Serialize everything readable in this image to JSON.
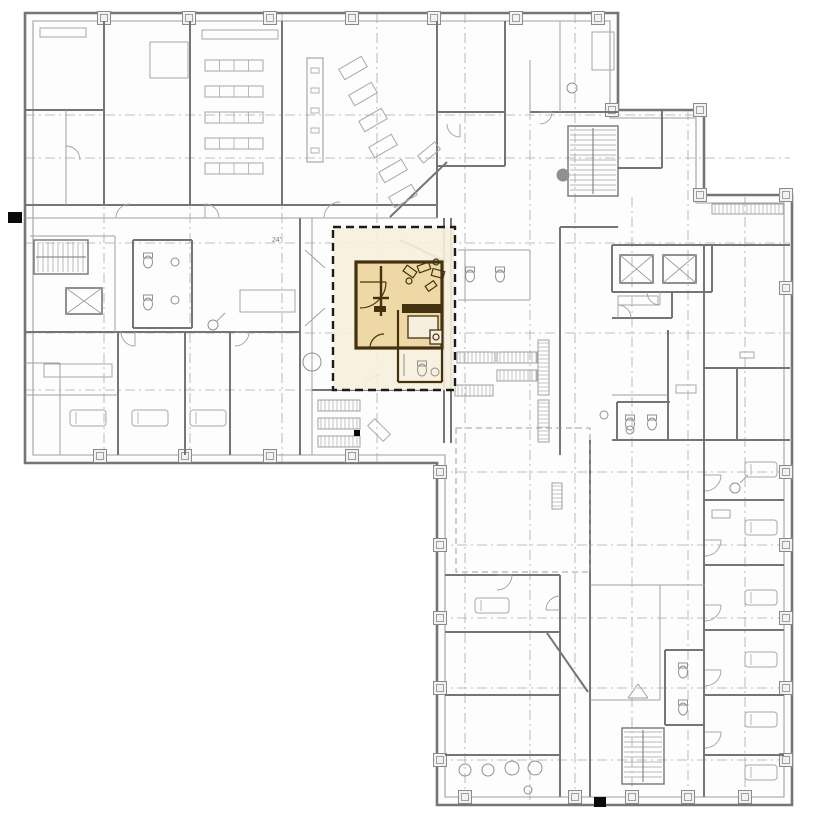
{
  "meta": {
    "title": "Hospital floor plan with highlighted patient-room unit",
    "dim_note": "24'"
  },
  "canvas": {
    "w": 826,
    "h": 826,
    "bg": "#ffffff"
  },
  "palette": {
    "wall": "#757575",
    "thin": "#a0a0a0",
    "furniture": "#a8a8a8",
    "grid": "#aaaaaa",
    "paper": "#fdfdfd",
    "marker_stroke": "#8a8a8a",
    "marker_fill": "#f2f2f2",
    "fixture": "#909090",
    "black": "#0a0a0a",
    "highlight_fill": "#f7efdd",
    "highlight_room_fill": "#eed9a6",
    "highlight_wall": "#43310f",
    "highlight_border": "#1c1c1c",
    "text": "#7a7a7a"
  },
  "outline": {
    "outer": "25,13 618,13 618,110 704,110 704,195 792,195 792,805 437,805 437,463 25,463",
    "inner": "33,21 610,21 610,118 696,118 696,203 784,203 784,797 445,797 445,455 33,455"
  },
  "grid": {
    "vertical": [
      [
        104,
        13,
        463
      ],
      [
        190,
        13,
        463
      ],
      [
        282,
        13,
        463
      ],
      [
        377,
        13,
        463
      ],
      [
        465,
        13,
        805
      ],
      [
        530,
        110,
        805
      ],
      [
        575,
        13,
        805
      ],
      [
        632,
        197,
        805
      ],
      [
        688,
        110,
        805
      ],
      [
        745,
        197,
        805
      ]
    ],
    "horizontal": [
      [
        115,
        25,
        700
      ],
      [
        158,
        25,
        790
      ],
      [
        243,
        25,
        790
      ],
      [
        333,
        25,
        790
      ],
      [
        390,
        25,
        437
      ],
      [
        472,
        437,
        790
      ],
      [
        545,
        437,
        790
      ],
      [
        618,
        437,
        790
      ],
      [
        688,
        437,
        790
      ],
      [
        760,
        437,
        790
      ]
    ]
  },
  "column_markers": [
    [
      104,
      18
    ],
    [
      189,
      18
    ],
    [
      270,
      18
    ],
    [
      352,
      18
    ],
    [
      434,
      18
    ],
    [
      516,
      18
    ],
    [
      598,
      18
    ],
    [
      612,
      110
    ],
    [
      700,
      110
    ],
    [
      700,
      195
    ],
    [
      786,
      195
    ],
    [
      100,
      456
    ],
    [
      185,
      456
    ],
    [
      270,
      456
    ],
    [
      352,
      456
    ],
    [
      440,
      472
    ],
    [
      440,
      545
    ],
    [
      440,
      618
    ],
    [
      440,
      688
    ],
    [
      440,
      760
    ],
    [
      786,
      288
    ],
    [
      786,
      472
    ],
    [
      786,
      545
    ],
    [
      786,
      618
    ],
    [
      786,
      688
    ],
    [
      786,
      760
    ],
    [
      465,
      797
    ],
    [
      575,
      797
    ],
    [
      632,
      797
    ],
    [
      688,
      797
    ],
    [
      745,
      797
    ]
  ],
  "walls": [
    [
      104,
      21,
      104,
      205
    ],
    [
      190,
      21,
      190,
      205
    ],
    [
      282,
      21,
      282,
      205
    ],
    [
      437,
      21,
      437,
      218
    ],
    [
      25,
      110,
      104,
      110
    ],
    [
      25,
      205,
      437,
      205
    ],
    [
      437,
      112,
      505,
      112
    ],
    [
      530,
      112,
      618,
      112
    ],
    [
      505,
      21,
      505,
      112
    ],
    [
      437,
      166,
      505,
      166
    ],
    [
      505,
      112,
      505,
      166
    ],
    [
      390,
      217,
      447,
      162
    ],
    [
      25,
      332,
      300,
      332
    ],
    [
      300,
      218,
      300,
      455
    ],
    [
      133,
      240,
      192,
      240
    ],
    [
      133,
      240,
      133,
      328
    ],
    [
      192,
      240,
      192,
      328
    ],
    [
      133,
      328,
      192,
      328
    ],
    [
      118,
      332,
      118,
      455
    ],
    [
      185,
      332,
      185,
      455
    ],
    [
      230,
      332,
      230,
      455
    ],
    [
      312,
      390,
      437,
      390
    ],
    [
      444,
      218,
      444,
      443
    ],
    [
      451,
      218,
      451,
      443
    ],
    [
      400,
      240,
      447,
      262
    ],
    [
      618,
      168,
      662,
      168
    ],
    [
      662,
      110,
      662,
      168
    ],
    [
      704,
      245,
      790,
      245
    ],
    [
      704,
      245,
      704,
      797
    ],
    [
      612,
      245,
      712,
      245
    ],
    [
      612,
      292,
      712,
      292
    ],
    [
      612,
      245,
      612,
      292
    ],
    [
      712,
      245,
      712,
      292
    ],
    [
      672,
      292,
      672,
      318
    ],
    [
      612,
      318,
      672,
      318
    ],
    [
      560,
      227,
      618,
      227
    ],
    [
      560,
      227,
      560,
      455
    ],
    [
      612,
      440,
      790,
      440
    ],
    [
      668,
      330,
      668,
      440
    ],
    [
      737,
      368,
      737,
      440
    ],
    [
      704,
      368,
      790,
      368
    ],
    [
      590,
      440,
      590,
      797
    ],
    [
      560,
      575,
      560,
      797
    ],
    [
      445,
      575,
      560,
      575
    ],
    [
      445,
      632,
      560,
      632
    ],
    [
      445,
      695,
      560,
      695
    ],
    [
      445,
      755,
      560,
      755
    ],
    [
      547,
      633,
      588,
      692
    ],
    [
      705,
      500,
      784,
      500
    ],
    [
      705,
      565,
      784,
      565
    ],
    [
      705,
      630,
      784,
      630
    ],
    [
      705,
      695,
      784,
      695
    ],
    [
      705,
      755,
      784,
      755
    ],
    [
      617,
      402,
      617,
      440
    ],
    [
      617,
      402,
      670,
      402
    ],
    [
      665,
      650,
      665,
      725
    ],
    [
      665,
      650,
      705,
      650
    ],
    [
      665,
      725,
      705,
      725
    ]
  ],
  "thin_walls": [
    [
      66,
      110,
      66,
      205
    ],
    [
      25,
      218,
      437,
      218
    ],
    [
      312,
      218,
      312,
      455
    ],
    [
      115,
      236,
      115,
      332
    ],
    [
      30,
      236,
      115,
      236
    ],
    [
      60,
      363,
      60,
      455
    ],
    [
      25,
      363,
      60,
      363
    ],
    [
      25,
      395,
      118,
      395
    ],
    [
      530,
      60,
      530,
      112
    ],
    [
      560,
      21,
      560,
      112
    ],
    [
      590,
      585,
      705,
      585
    ],
    [
      660,
      585,
      660,
      700
    ],
    [
      590,
      700,
      660,
      700
    ],
    [
      612,
      395,
      668,
      395
    ],
    [
      465,
      250,
      465,
      300
    ],
    [
      530,
      250,
      530,
      300
    ],
    [
      458,
      250,
      530,
      250
    ],
    [
      458,
      300,
      530,
      300
    ],
    [
      305,
      250,
      325,
      268
    ],
    [
      305,
      326,
      325,
      308
    ],
    [
      628,
      698,
      648,
      698
    ],
    [
      628,
      698,
      638,
      684
    ],
    [
      648,
      698,
      638,
      684
    ],
    [
      217,
      321,
      225,
      313
    ],
    [
      740,
      483,
      748,
      475
    ]
  ],
  "furniture_rects": [
    [
      40,
      28,
      46,
      9
    ],
    [
      202,
      30,
      76,
      9
    ],
    [
      592,
      32,
      22,
      38
    ],
    [
      150,
      42,
      38,
      36
    ],
    [
      240,
      290,
      55,
      22
    ],
    [
      44,
      364,
      68,
      13
    ],
    [
      618,
      296,
      40,
      9
    ],
    [
      676,
      385,
      20,
      8
    ],
    [
      712,
      510,
      18,
      8
    ],
    [
      740,
      352,
      14,
      6
    ]
  ],
  "tables": [
    [
      205,
      60,
      58,
      11,
      4
    ],
    [
      205,
      86,
      58,
      11,
      4
    ],
    [
      205,
      112,
      58,
      11,
      4
    ],
    [
      205,
      138,
      58,
      11,
      4
    ],
    [
      205,
      163,
      58,
      11,
      4
    ]
  ],
  "beds": [
    [
      70,
      410,
      36,
      16
    ],
    [
      132,
      410,
      36,
      16
    ],
    [
      190,
      410,
      36,
      16
    ],
    [
      745,
      462,
      32,
      15
    ],
    [
      745,
      520,
      32,
      15
    ],
    [
      745,
      590,
      32,
      15
    ],
    [
      745,
      652,
      32,
      15
    ],
    [
      745,
      712,
      32,
      15
    ],
    [
      745,
      765,
      32,
      15
    ],
    [
      475,
      598,
      34,
      15
    ]
  ],
  "rotated_rects": [
    [
      340,
      62,
      26,
      12,
      -30
    ],
    [
      350,
      88,
      26,
      12,
      -30
    ],
    [
      360,
      114,
      26,
      12,
      -30
    ],
    [
      370,
      140,
      26,
      12,
      -30
    ],
    [
      380,
      165,
      26,
      12,
      -30
    ],
    [
      390,
      190,
      26,
      12,
      -30
    ],
    [
      418,
      148,
      22,
      9,
      -40
    ],
    [
      368,
      425,
      22,
      10,
      45
    ]
  ],
  "circles": [
    [
      175,
      262,
      4,
      0
    ],
    [
      175,
      300,
      4,
      0
    ],
    [
      572,
      88,
      5,
      0
    ],
    [
      563,
      175,
      6,
      1
    ],
    [
      213,
      325,
      5,
      0
    ],
    [
      735,
      488,
      5,
      0
    ],
    [
      604,
      415,
      4,
      0
    ],
    [
      312,
      362,
      9,
      0
    ],
    [
      465,
      770,
      6,
      0
    ],
    [
      488,
      770,
      6,
      0
    ],
    [
      512,
      768,
      7,
      0
    ],
    [
      535,
      768,
      7,
      0
    ],
    [
      528,
      790,
      4,
      0
    ],
    [
      630,
      430,
      4,
      0
    ]
  ],
  "toilets": [
    [
      148,
      258
    ],
    [
      148,
      300
    ],
    [
      470,
      272
    ],
    [
      500,
      272
    ],
    [
      683,
      668
    ],
    [
      683,
      705
    ],
    [
      630,
      420
    ],
    [
      652,
      420
    ]
  ],
  "racks": [
    [
      318,
      400,
      42,
      11
    ],
    [
      318,
      418,
      42,
      11
    ],
    [
      318,
      436,
      42,
      11
    ],
    [
      457,
      352,
      38,
      11
    ],
    [
      497,
      352,
      40,
      11
    ],
    [
      497,
      370,
      40,
      11
    ],
    [
      455,
      385,
      38,
      11
    ],
    [
      538,
      340,
      11,
      55
    ],
    [
      538,
      400,
      11,
      42
    ],
    [
      552,
      483,
      10,
      26
    ],
    [
      712,
      204,
      72,
      10
    ]
  ],
  "stairs": [
    [
      34,
      240,
      54,
      34,
      "v"
    ],
    [
      568,
      126,
      50,
      70,
      "h"
    ],
    [
      622,
      728,
      42,
      56,
      "h"
    ]
  ],
  "elevators": [
    [
      620,
      255,
      33,
      28
    ],
    [
      663,
      255,
      33,
      28
    ],
    [
      66,
      288,
      36,
      26
    ]
  ],
  "cabinet": {
    "rect": [
      307,
      58,
      16,
      104
    ],
    "slots": [
      [
        311,
        68,
        8,
        5
      ],
      [
        311,
        88,
        8,
        5
      ],
      [
        311,
        108,
        8,
        5
      ],
      [
        311,
        128,
        8,
        5
      ],
      [
        311,
        148,
        8,
        5
      ]
    ]
  },
  "dashed_rects": [
    [
      456,
      428,
      134,
      144
    ]
  ],
  "doors": [
    [
      130,
      218,
      14,
      180,
      270
    ],
    [
      205,
      218,
      14,
      270,
      360
    ],
    [
      340,
      218,
      16,
      180,
      270
    ],
    [
      460,
      124,
      13,
      90,
      180
    ],
    [
      540,
      112,
      12,
      0,
      90
    ],
    [
      66,
      160,
      14,
      270,
      360
    ],
    [
      235,
      332,
      14,
      0,
      90
    ],
    [
      135,
      332,
      14,
      90,
      180
    ],
    [
      380,
      390,
      15,
      180,
      270
    ],
    [
      705,
      475,
      16,
      0,
      90
    ],
    [
      705,
      540,
      16,
      0,
      90
    ],
    [
      705,
      605,
      16,
      0,
      90
    ],
    [
      705,
      670,
      16,
      0,
      90
    ],
    [
      705,
      732,
      16,
      0,
      90
    ],
    [
      560,
      610,
      14,
      180,
      270
    ],
    [
      497,
      575,
      15,
      0,
      90
    ],
    [
      660,
      292,
      13,
      90,
      180
    ],
    [
      618,
      318,
      13,
      270,
      360
    ],
    [
      452,
      244,
      12,
      90,
      180
    ]
  ],
  "black_marks": [
    [
      8,
      212,
      14,
      11
    ],
    [
      594,
      797,
      12,
      10
    ],
    [
      354,
      430,
      6,
      6
    ]
  ],
  "texts": [
    {
      "x": 272,
      "y": 242,
      "t": "24'",
      "size": 7
    }
  ],
  "highlight": {
    "region": {
      "x": 333,
      "y": 227,
      "w": 122,
      "h": 163
    },
    "room": {
      "x": 356,
      "y": 262,
      "w": 86,
      "h": 86
    },
    "bath_walls": [
      [
        398,
        310,
        398,
        382
      ],
      [
        398,
        382,
        442,
        382
      ],
      [
        442,
        348,
        442,
        382
      ]
    ],
    "lines": [
      [
        381,
        266,
        381,
        316
      ],
      [
        373,
        298,
        389,
        298
      ]
    ],
    "filled_bars": [
      [
        402,
        304,
        40,
        9
      ],
      [
        374,
        306,
        12,
        6
      ]
    ],
    "rects": [
      [
        408,
        316,
        30,
        22
      ],
      [
        430,
        330,
        12,
        14
      ]
    ],
    "rotated_rects": [
      [
        404,
        268,
        12,
        7,
        35
      ],
      [
        418,
        264,
        12,
        7,
        -20
      ],
      [
        432,
        270,
        12,
        7,
        15
      ],
      [
        426,
        283,
        10,
        6,
        -35
      ]
    ],
    "circles": [
      [
        409,
        281,
        3
      ],
      [
        436,
        262,
        3
      ],
      [
        436,
        337,
        3
      ]
    ],
    "doors": [
      [
        360,
        282,
        26,
        0,
        90
      ],
      [
        384,
        348,
        14,
        180,
        270
      ]
    ],
    "gray_fixture_toilet": [
      422,
      366
    ],
    "gray_circle": [
      435,
      372,
      4
    ],
    "gray_line": [
      404,
      354,
      404,
      376
    ]
  }
}
